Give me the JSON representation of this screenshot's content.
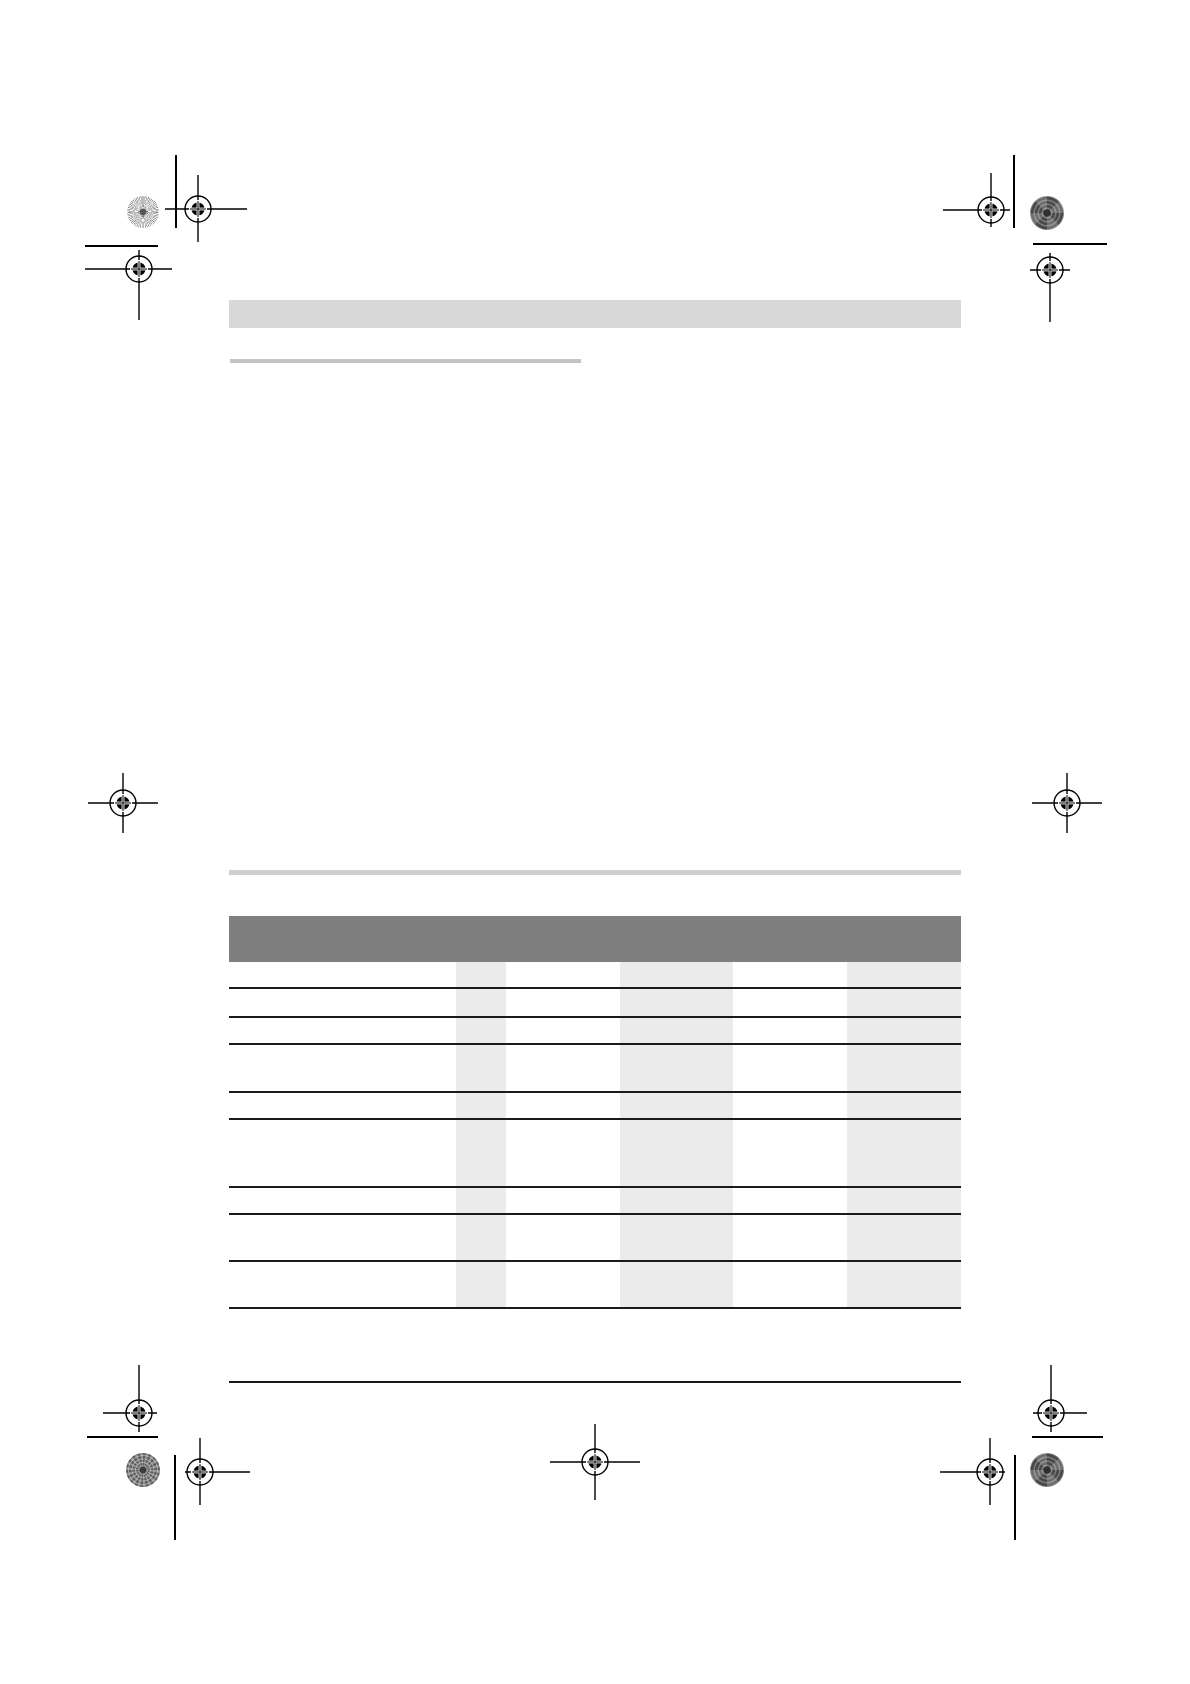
{
  "document": {
    "kind": "print proof page with registration marks and empty table",
    "visible_text": ""
  },
  "colors": {
    "page_background": "#ffffff",
    "header_band": "#d8d8d8",
    "title_underline": "#c3c3c3",
    "section_divider": "#cfcfcf",
    "table_header_band": "#7f7f7f",
    "table_column_stripe": "#ebebeb",
    "table_row_line": "#1a1a1a",
    "footer_rule": "#1a1a1a",
    "mark_ink": "#000000"
  },
  "table": {
    "column_count": 6,
    "shaded_column_positions": [
      2,
      4,
      6
    ],
    "body_row_count": 9,
    "has_header_band": true
  },
  "decorations": {
    "registration_mark_count": 11,
    "sunburst_patch_count": 1,
    "halftone_patch_count": 1,
    "pinwheel_patch_count": 2,
    "crop_line_count": 8
  }
}
